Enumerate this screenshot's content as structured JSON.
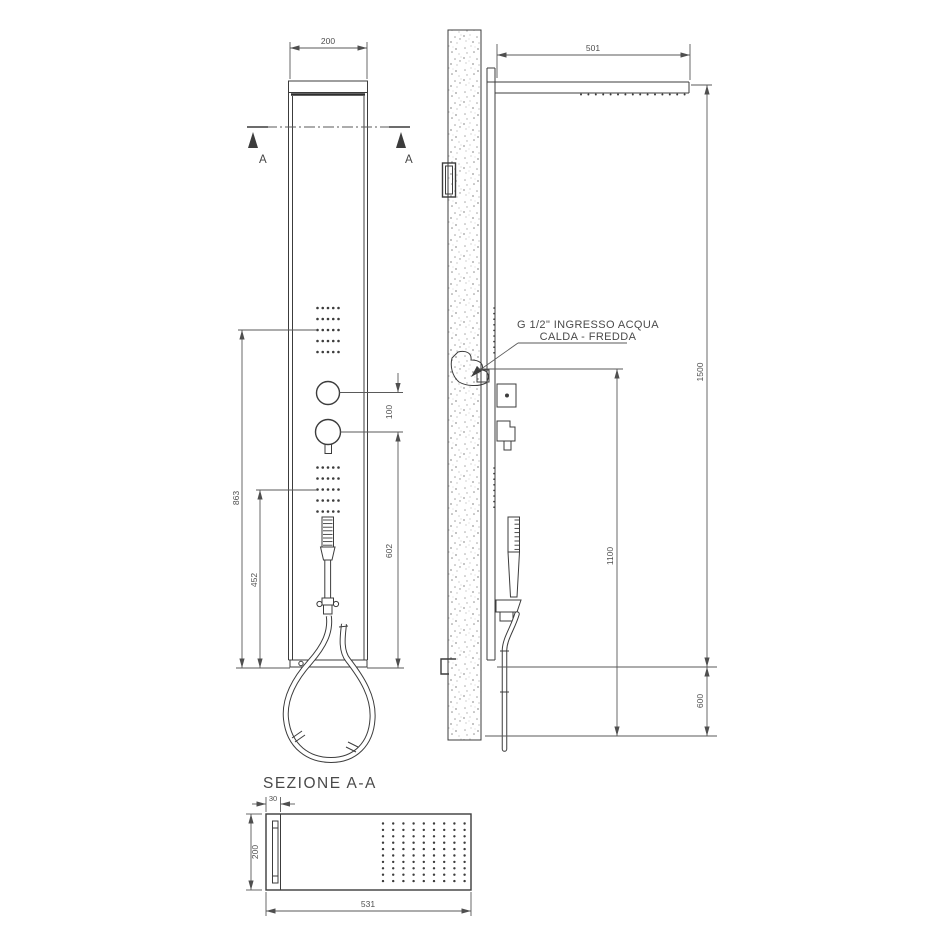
{
  "colors": {
    "line": "#3c3c3c",
    "text": "#4f4f4f",
    "wall_speckle": "#a0a0a0"
  },
  "front_view": {
    "dim_width_top": "200",
    "section_marker_left": "A",
    "section_marker_right": "A",
    "dim_knob_spacing": "100",
    "dim_jets_to_base": "863",
    "dim_lower_jets_to_base": "452",
    "dim_mixer_to_base": "602"
  },
  "side_view": {
    "dim_arm_length": "501",
    "dim_panel_height": "1500",
    "dim_inlet_height": "1100",
    "dim_floor_gap": "600",
    "inlet_label_line1": "G 1/2\" INGRESSO ACQUA",
    "inlet_label_line2": "CALDA - FREDDA"
  },
  "section_view": {
    "title": "SEZIONE A-A",
    "dim_depth": "30",
    "dim_width": "200",
    "dim_length": "531"
  }
}
